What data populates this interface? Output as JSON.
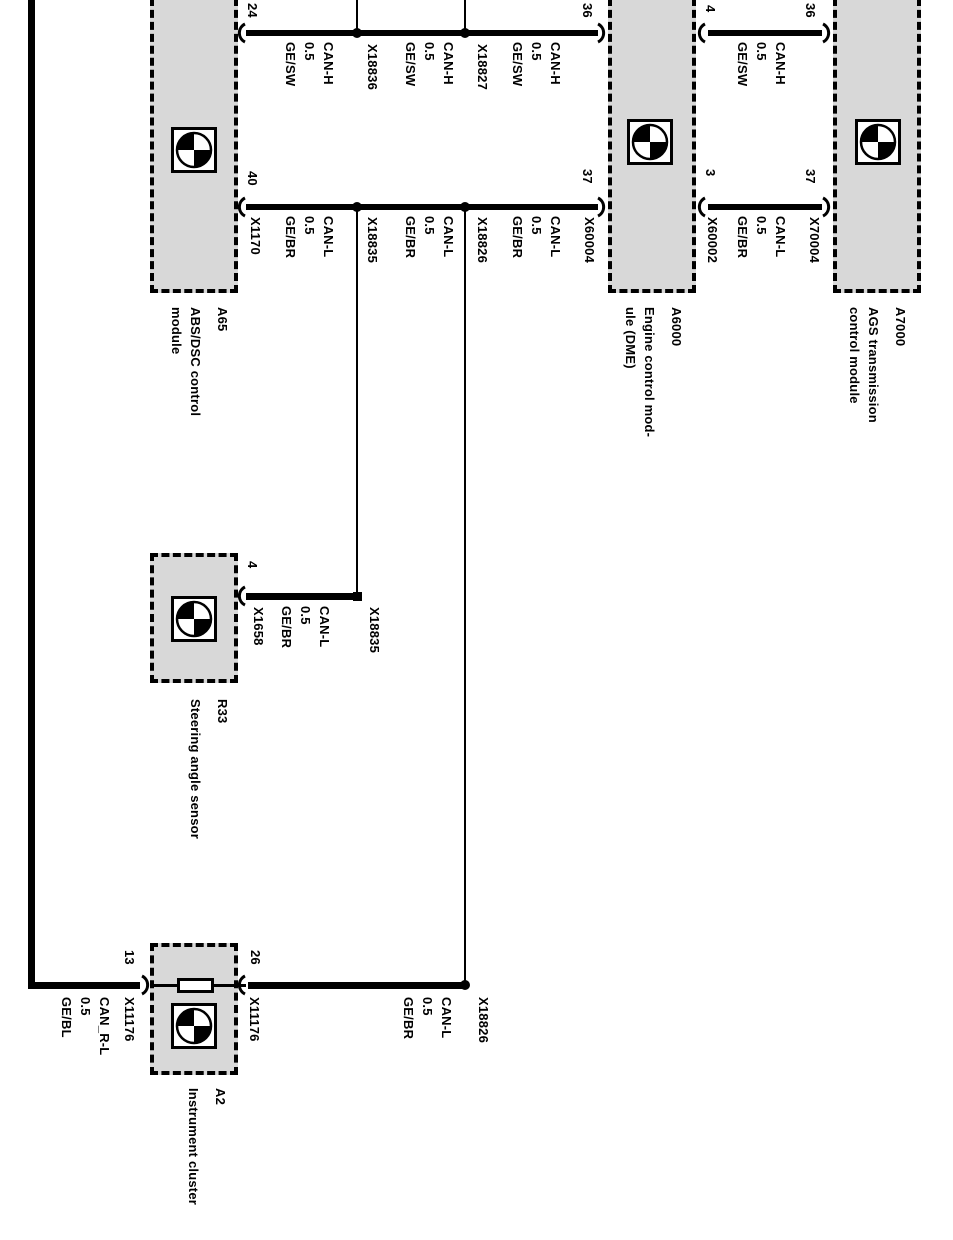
{
  "diagram_title": "CAN bus wiring diagram",
  "colors": {
    "background": "#ffffff",
    "line": "#000000",
    "module_fill": "#d8d8d8"
  },
  "modules": [
    {
      "code": "A65",
      "name": [
        "ABS/DSC control",
        "module"
      ]
    },
    {
      "code": "A6000",
      "name": [
        "Engine control mod-",
        "ule (DME)"
      ]
    },
    {
      "code": "A7000",
      "name": [
        "AGS transmission",
        "control module"
      ]
    },
    {
      "code": "R33",
      "name": [
        "Steering angle sensor"
      ]
    },
    {
      "code": "A2",
      "name": [
        "Instrument cluster"
      ]
    }
  ],
  "pins": {
    "abs_can_h": "24",
    "abs_can_l": "40",
    "dme_left_h": "36",
    "dme_left_l": "37",
    "dme_right_h": "4",
    "dme_right_l": "3",
    "ags_h": "36",
    "ags_l": "37",
    "sas": "4",
    "cluster_left": "13",
    "cluster_right": "26"
  },
  "connectors": {
    "x18836": "X18836",
    "x18827": "X18827",
    "x1170": "X1170",
    "x18835_bus": "X18835",
    "x18826_bus": "X18826",
    "x60004": "X60004",
    "x60002": "X60002",
    "x70004": "X70004",
    "x1658": "X1658",
    "x18835_sas": "X18835",
    "x11176_left": "X11176",
    "x11176_right": "X11176",
    "x18826_cluster": "X18826"
  },
  "wire_labels": [
    {
      "signal": "CAN-H",
      "size": "0.5",
      "color": "GE/SW"
    },
    {
      "signal": "CAN-H",
      "size": "0.5",
      "color": "GE/SW"
    },
    {
      "signal": "CAN-H",
      "size": "0.5",
      "color": "GE/SW"
    },
    {
      "signal": "CAN-L",
      "size": "0.5",
      "color": "GE/BR"
    },
    {
      "signal": "CAN-L",
      "size": "0.5",
      "color": "GE/BR"
    },
    {
      "signal": "CAN-L",
      "size": "0.5",
      "color": "GE/BR"
    },
    {
      "signal": "CAN-H",
      "size": "0.5",
      "color": "GE/SW"
    },
    {
      "signal": "CAN-L",
      "size": "0.5",
      "color": "GE/BR"
    },
    {
      "signal": "CAN-L",
      "size": "0.5",
      "color": "GE/BR"
    },
    {
      "signal": "CAN_R-L",
      "size": "0.5",
      "color": "GE/BL"
    },
    {
      "signal": "CAN-L",
      "size": "0.5",
      "color": "GE/BR"
    }
  ]
}
